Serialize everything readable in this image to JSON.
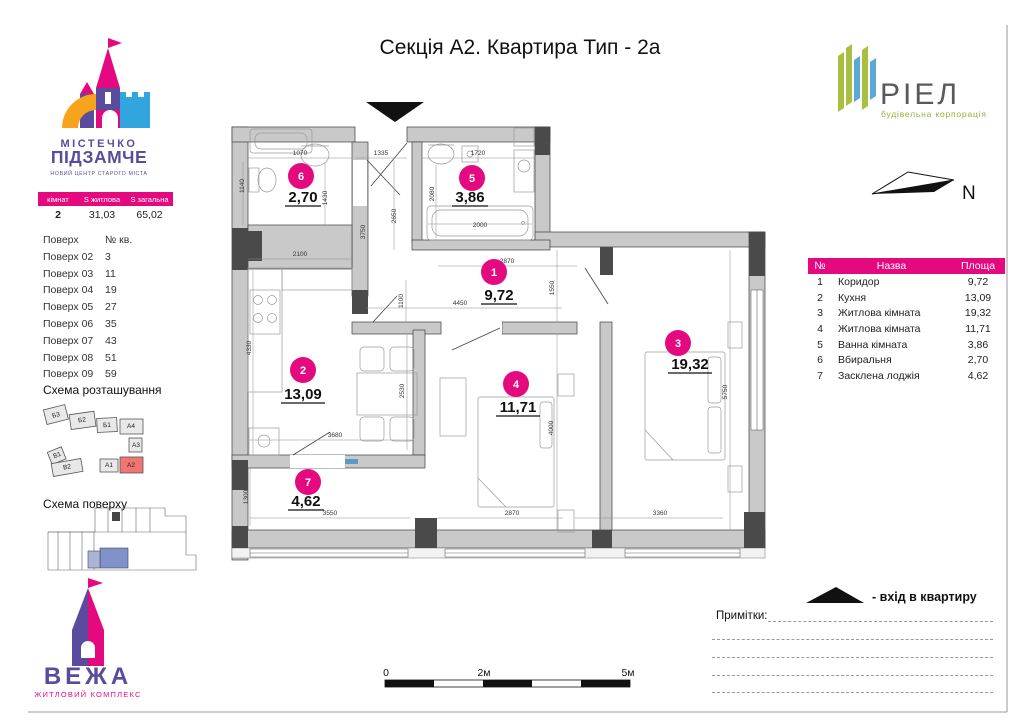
{
  "title": "Секція А2. Квартира Тип - 2а",
  "brand_top": {
    "line1": "МІСТЕЧКО",
    "line2": "ПІДЗАМЧЕ",
    "tagline": "НОВИЙ ЦЕНТР СТАРОГО МІСТА"
  },
  "summary": {
    "headers": [
      "кімнат",
      "S житлова",
      "S загальна"
    ],
    "rooms": "2",
    "living": "31,03",
    "total": "65,02"
  },
  "floors": {
    "header_floor": "Поверх",
    "header_apt": "№ кв.",
    "rows": [
      [
        "Поверх 02",
        "3"
      ],
      [
        "Поверх 03",
        "11"
      ],
      [
        "Поверх 04",
        "19"
      ],
      [
        "Поверх 05",
        "27"
      ],
      [
        "Поверх 06",
        "35"
      ],
      [
        "Поверх 07",
        "43"
      ],
      [
        "Поверх 08",
        "51"
      ],
      [
        "Поверх 09",
        "59"
      ]
    ]
  },
  "section_location": "Схема розташування",
  "site_blocks": {
    "b3": "Б3",
    "b2": "Б2",
    "b1": "Б1",
    "a4": "А4",
    "a3": "А3",
    "a2": "А2",
    "a1": "А1",
    "v1": "В1",
    "v2": "В2"
  },
  "section_floorplan": "Схема поверху",
  "brand_bottom": {
    "name": "ВЕЖА",
    "tagline": "ЖИТЛОВИЙ КОМПЛЕКС"
  },
  "developer": {
    "name": "РІЕЛ",
    "tagline": "будівельна корпорація"
  },
  "compass": {
    "label": "N"
  },
  "rooms_table": {
    "headers": [
      "№",
      "Назва",
      "Площа"
    ],
    "rows": [
      [
        "1",
        "Коридор",
        "9,72"
      ],
      [
        "2",
        "Кухня",
        "13,09"
      ],
      [
        "3",
        "Житлова кімната",
        "19,32"
      ],
      [
        "4",
        "Житлова кімната",
        "11,71"
      ],
      [
        "5",
        "Ванна кімната",
        "3,86"
      ],
      [
        "6",
        "Вбиральня",
        "2,70"
      ],
      [
        "7",
        "Засклена лоджія",
        "4,62"
      ]
    ]
  },
  "legend_entrance": "-  вхід в квартиру",
  "notes_label": "Примітки:",
  "scalebar": {
    "zero": "0",
    "two": "2м",
    "five": "5м"
  },
  "plan": {
    "rooms": [
      {
        "num": "1",
        "area": "9,72"
      },
      {
        "num": "2",
        "area": "13,09"
      },
      {
        "num": "3",
        "area": "19,32"
      },
      {
        "num": "4",
        "area": "11,71"
      },
      {
        "num": "5",
        "area": "3,86"
      },
      {
        "num": "6",
        "area": "2,70"
      },
      {
        "num": "7",
        "area": "4,62"
      }
    ],
    "dims": {
      "d1070": "1070",
      "d1335": "1335",
      "d1720": "1720",
      "d1140": "1140",
      "d1430": "1430",
      "d2080": "2080",
      "d2650": "2650",
      "d3750": "3750",
      "d2000": "2000",
      "d2100": "2100",
      "d2870a": "2870",
      "d1550": "1550",
      "d4450": "4450",
      "d1100": "1100",
      "d4330": "4330",
      "d2530": "2530",
      "d3680": "3680",
      "d4000": "4000",
      "d5750": "5750",
      "d1300": "1300",
      "d3550": "3550",
      "d2870b": "2870",
      "d3360": "3360"
    }
  },
  "colors": {
    "magenta": "#e5097f",
    "purple": "#5b4b9e",
    "blue": "#31a5de",
    "orange": "#f7a41d",
    "green": "#8cb63c",
    "wall": "#c9c9c9",
    "dark": "#4a4a4a",
    "site_highlight": "#ef7674",
    "floor_highlight": "#8191c9"
  }
}
